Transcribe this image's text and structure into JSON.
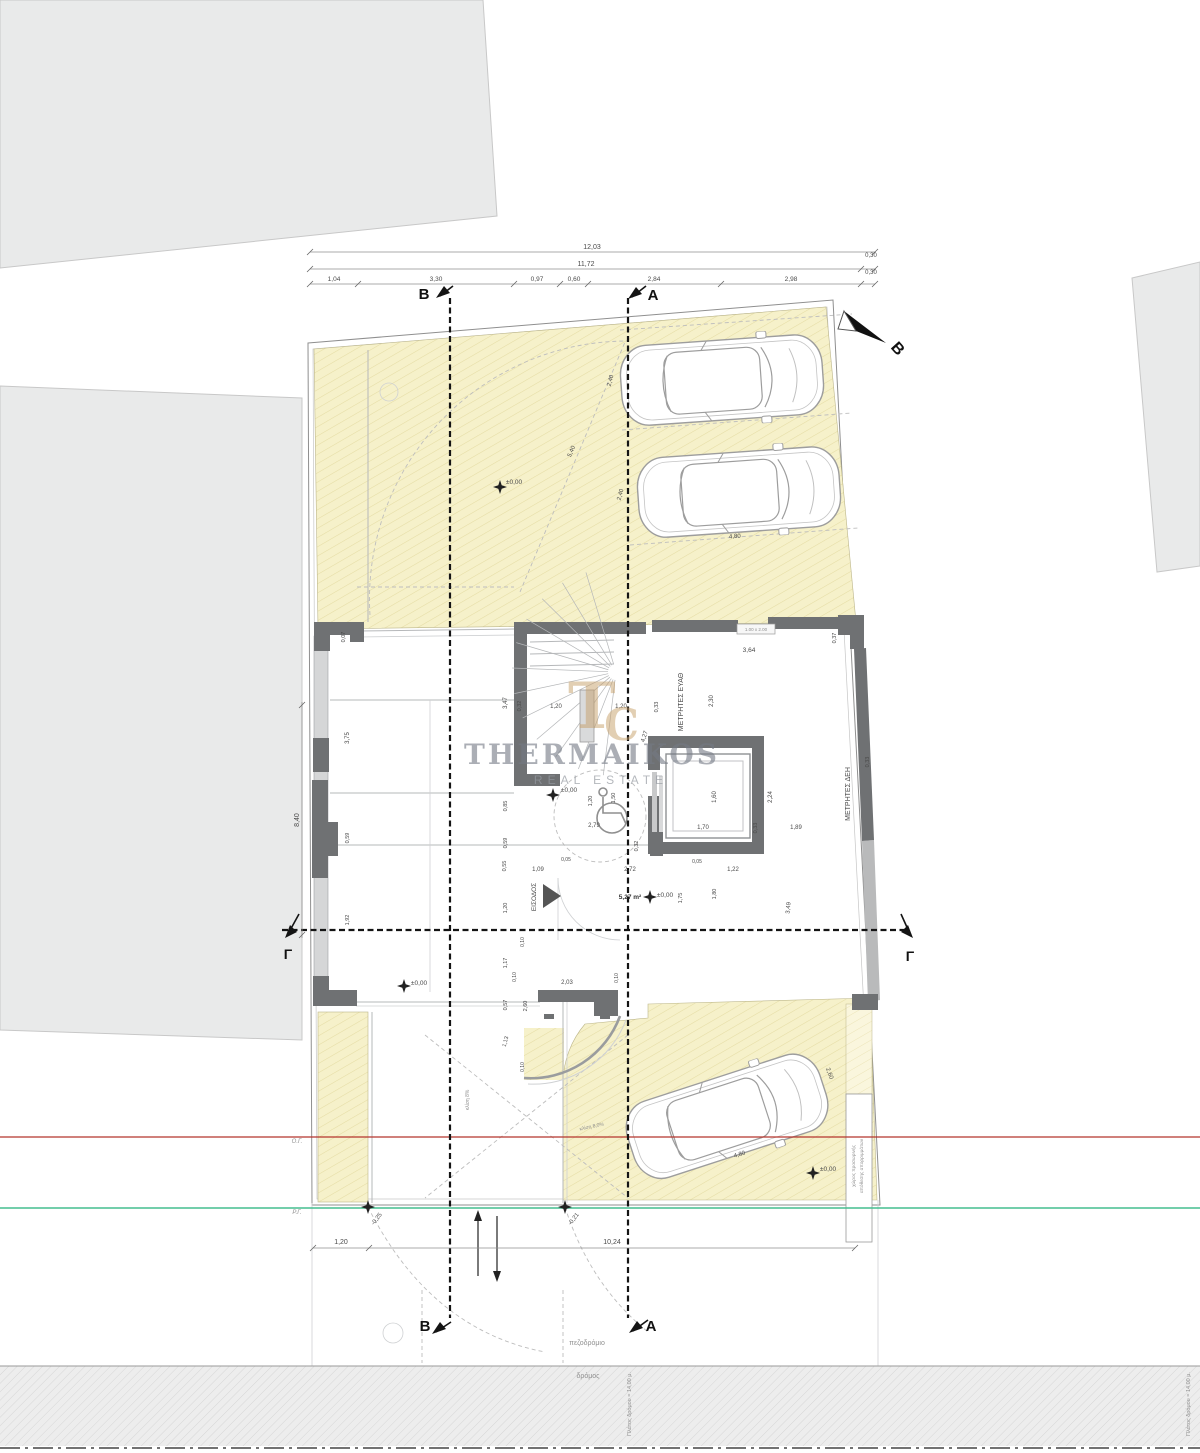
{
  "title": "Κάτοψη ισογείου",
  "branding": {
    "name": "THERMAIKOS",
    "subtitle": "REAL ESTATE",
    "monogram_left": "T",
    "monogram_right": "C",
    "logo_color": "#c7a06a",
    "text_color": "#747a85"
  },
  "colors": {
    "plot_fill": "#f6f1ca",
    "plot_hatch": "#e5dca4",
    "wall_dark": "#6f7173",
    "neighbor_fill": "#e9eaea",
    "building_line_red": "#b5352c",
    "street_line_green": "#45bd8f",
    "road_fill": "#ededed"
  },
  "legend": {
    "building_line": "Ο.Γ.",
    "street_line": "Ρ.Γ."
  },
  "labels": [
    {
      "n": "dim-total-top",
      "t": "12,03",
      "x": 592,
      "y": 249,
      "r": 0,
      "s": 7,
      "c": ""
    },
    {
      "n": "dim-top",
      "t": "11,72",
      "x": 586,
      "y": 266,
      "r": 0,
      "s": 7,
      "c": ""
    },
    {
      "n": "dim-top",
      "t": "0,30",
      "x": 871,
      "y": 257,
      "r": 0,
      "s": 6,
      "c": ""
    },
    {
      "n": "dim-top",
      "t": "0,30",
      "x": 871,
      "y": 274,
      "r": 0,
      "s": 6,
      "c": ""
    },
    {
      "n": "dim-top",
      "t": "1,04",
      "x": 334,
      "y": 281,
      "r": 0,
      "s": 6.5,
      "c": ""
    },
    {
      "n": "dim-top",
      "t": "3,30",
      "x": 436,
      "y": 281,
      "r": 0,
      "s": 6.5,
      "c": ""
    },
    {
      "n": "dim-top",
      "t": "0,97",
      "x": 537,
      "y": 281,
      "r": 0,
      "s": 6.5,
      "c": ""
    },
    {
      "n": "dim-top",
      "t": "0,60",
      "x": 574,
      "y": 281,
      "r": 0,
      "s": 6.5,
      "c": ""
    },
    {
      "n": "dim-top",
      "t": "2,84",
      "x": 654,
      "y": 281,
      "r": 0,
      "s": 6.5,
      "c": ""
    },
    {
      "n": "dim-top",
      "t": "2,98",
      "x": 791,
      "y": 281,
      "r": 0,
      "s": 6.5,
      "c": ""
    },
    {
      "n": "section-label-b-top",
      "t": "B",
      "x": 424,
      "y": 299,
      "r": 0,
      "s": 15,
      "c": "lbl-bold"
    },
    {
      "n": "section-label-a-top",
      "t": "A",
      "x": 653,
      "y": 300,
      "r": 0,
      "s": 15,
      "c": "lbl-bold"
    },
    {
      "n": "north-label",
      "t": "Β",
      "x": 894,
      "y": 352,
      "r": 48,
      "s": 16,
      "c": "lbl-bold"
    },
    {
      "n": "section-label-b-bottom",
      "t": "B",
      "x": 425,
      "y": 1331,
      "r": 0,
      "s": 15,
      "c": "lbl-bold"
    },
    {
      "n": "section-label-a-bottom",
      "t": "A",
      "x": 651,
      "y": 1331,
      "r": 0,
      "s": 15,
      "c": "lbl-bold"
    },
    {
      "n": "section-label-g-left",
      "t": "Γ",
      "x": 288,
      "y": 959,
      "r": 0,
      "s": 14,
      "c": "lbl-bold"
    },
    {
      "n": "section-label-g-right",
      "t": "Γ",
      "x": 910,
      "y": 961,
      "r": 0,
      "s": 14,
      "c": "lbl-bold"
    },
    {
      "n": "level-garden",
      "t": "±0,00",
      "x": 514,
      "y": 484,
      "r": 0,
      "s": 6.5,
      "c": ""
    },
    {
      "n": "dim-parking",
      "t": "2,40",
      "x": 612,
      "y": 381,
      "r": -75,
      "s": 6,
      "c": ""
    },
    {
      "n": "dim-parking",
      "t": "2,40",
      "x": 622,
      "y": 495,
      "r": -75,
      "s": 6,
      "c": ""
    },
    {
      "n": "dim-parking",
      "t": "5,40",
      "x": 573,
      "y": 452,
      "r": -67,
      "s": 6,
      "c": ""
    },
    {
      "n": "dim-parking",
      "t": "4,80",
      "x": 735,
      "y": 538,
      "r": -4,
      "s": 6,
      "c": ""
    },
    {
      "n": "dim",
      "t": "0,07",
      "x": 345,
      "y": 637,
      "r": -90,
      "s": 5.5,
      "c": ""
    },
    {
      "n": "dim",
      "t": "3,64",
      "x": 749,
      "y": 652,
      "r": 0,
      "s": 6.5,
      "c": ""
    },
    {
      "n": "window-size-label",
      "t": "1.00 x 2.00",
      "x": 756,
      "y": 631,
      "r": 0,
      "s": 4.5,
      "c": "lbl-faint"
    },
    {
      "n": "dim",
      "t": "0,37",
      "x": 836,
      "y": 638,
      "r": -90,
      "s": 5.5,
      "c": ""
    },
    {
      "n": "room-label-meters-eyath",
      "t": "ΜΕΤΡΗΤΕΣ ΕΥΑΘ",
      "x": 683,
      "y": 702,
      "r": -90,
      "s": 7,
      "c": ""
    },
    {
      "n": "dim",
      "t": "2,30",
      "x": 713,
      "y": 701,
      "r": -90,
      "s": 6,
      "c": ""
    },
    {
      "n": "dim",
      "t": "3,47",
      "x": 507,
      "y": 703,
      "r": -90,
      "s": 6,
      "c": ""
    },
    {
      "n": "dim",
      "t": "0,32",
      "x": 521,
      "y": 706,
      "r": -90,
      "s": 5.5,
      "c": ""
    },
    {
      "n": "dim",
      "t": "1,20",
      "x": 556,
      "y": 708,
      "r": 0,
      "s": 6,
      "c": ""
    },
    {
      "n": "dim",
      "t": "1,20",
      "x": 621,
      "y": 708,
      "r": 0,
      "s": 6,
      "c": ""
    },
    {
      "n": "dim",
      "t": "0,33",
      "x": 658,
      "y": 707,
      "r": -90,
      "s": 5.5,
      "c": ""
    },
    {
      "n": "dim",
      "t": "4,27",
      "x": 646,
      "y": 737,
      "r": -72,
      "s": 6,
      "c": ""
    },
    {
      "n": "dim",
      "t": "0,33",
      "x": 869,
      "y": 762,
      "r": -90,
      "s": 5.5,
      "c": ""
    },
    {
      "n": "dim",
      "t": "3,75",
      "x": 349,
      "y": 738,
      "r": -90,
      "s": 6,
      "c": ""
    },
    {
      "n": "dim-left-total",
      "t": "8,40",
      "x": 299,
      "y": 820,
      "r": -90,
      "s": 7,
      "c": ""
    },
    {
      "n": "dim",
      "t": "0,59",
      "x": 349,
      "y": 838,
      "r": -90,
      "s": 5.5,
      "c": ""
    },
    {
      "n": "dim",
      "t": "1,92",
      "x": 349,
      "y": 920,
      "r": -90,
      "s": 5.5,
      "c": ""
    },
    {
      "n": "dim-elevator",
      "t": "1,60",
      "x": 716,
      "y": 797,
      "r": -90,
      "s": 6,
      "c": ""
    },
    {
      "n": "dim-elevator",
      "t": "1,70",
      "x": 703,
      "y": 829,
      "r": 0,
      "s": 6,
      "c": ""
    },
    {
      "n": "dim-elevator",
      "t": "0,33",
      "x": 757,
      "y": 828,
      "r": -90,
      "s": 5.5,
      "c": ""
    },
    {
      "n": "dim",
      "t": "2,24",
      "x": 772,
      "y": 797,
      "r": -90,
      "s": 6,
      "c": ""
    },
    {
      "n": "dim",
      "t": "1,89",
      "x": 796,
      "y": 829,
      "r": 0,
      "s": 6,
      "c": ""
    },
    {
      "n": "room-label-meters-deh",
      "t": "ΜΕΤΡΗΤΕΣ ΔΕΗ",
      "x": 850,
      "y": 794,
      "r": -90,
      "s": 7,
      "c": ""
    },
    {
      "n": "level-hall",
      "t": "±0,00",
      "x": 569,
      "y": 792,
      "r": 0,
      "s": 6.5,
      "c": ""
    },
    {
      "n": "dim",
      "t": "1,20",
      "x": 592,
      "y": 801,
      "r": -90,
      "s": 5.5,
      "c": ""
    },
    {
      "n": "dim",
      "t": "1,50",
      "x": 615,
      "y": 798,
      "r": -90,
      "s": 5.5,
      "c": ""
    },
    {
      "n": "dim",
      "t": "2,79",
      "x": 594,
      "y": 827,
      "r": 0,
      "s": 6,
      "c": ""
    },
    {
      "n": "dim",
      "t": "0,32",
      "x": 638,
      "y": 846,
      "r": -90,
      "s": 5.5,
      "c": ""
    },
    {
      "n": "dim",
      "t": "0,85",
      "x": 507,
      "y": 806,
      "r": -90,
      "s": 5.5,
      "c": ""
    },
    {
      "n": "dim",
      "t": "0,59",
      "x": 507,
      "y": 843,
      "r": -90,
      "s": 5.5,
      "c": ""
    },
    {
      "n": "dim",
      "t": "0,55",
      "x": 506,
      "y": 866,
      "r": -90,
      "s": 5.5,
      "c": ""
    },
    {
      "n": "dim",
      "t": "1,09",
      "x": 538,
      "y": 871,
      "r": 0,
      "s": 6,
      "c": ""
    },
    {
      "n": "dim",
      "t": "0,05",
      "x": 566,
      "y": 861,
      "r": 0,
      "s": 5,
      "c": ""
    },
    {
      "n": "dim",
      "t": "2,72",
      "x": 630,
      "y": 871,
      "r": 0,
      "s": 6,
      "c": ""
    },
    {
      "n": "dim",
      "t": "0,05",
      "x": 697,
      "y": 863,
      "r": 0,
      "s": 5,
      "c": ""
    },
    {
      "n": "dim",
      "t": "1,22",
      "x": 733,
      "y": 871,
      "r": 0,
      "s": 6,
      "c": ""
    },
    {
      "n": "dim",
      "t": "1,20",
      "x": 507,
      "y": 908,
      "r": -90,
      "s": 5.5,
      "c": ""
    },
    {
      "n": "room-label-entrance",
      "t": "ΕΙΣΟΔΟΣ",
      "x": 536,
      "y": 897,
      "r": -90,
      "s": 6.5,
      "c": ""
    },
    {
      "n": "area-label",
      "t": "5,27 m²",
      "x": 630,
      "y": 899,
      "r": 0,
      "s": 6.5,
      "c": "lbl-semibold"
    },
    {
      "n": "level-walkway",
      "t": "±0,00",
      "x": 665,
      "y": 897,
      "r": 0,
      "s": 6.5,
      "c": ""
    },
    {
      "n": "dim",
      "t": "1,75",
      "x": 682,
      "y": 898,
      "r": -90,
      "s": 5.5,
      "c": ""
    },
    {
      "n": "dim",
      "t": "1,80",
      "x": 716,
      "y": 894,
      "r": -90,
      "s": 5.5,
      "c": ""
    },
    {
      "n": "dim",
      "t": "3,49",
      "x": 790,
      "y": 908,
      "r": -85,
      "s": 6,
      "c": ""
    },
    {
      "n": "level-pilotis",
      "t": "±0,00",
      "x": 419,
      "y": 985,
      "r": 0,
      "s": 6.5,
      "c": ""
    },
    {
      "n": "dim",
      "t": "1,17",
      "x": 507,
      "y": 963,
      "r": -90,
      "s": 5.5,
      "c": ""
    },
    {
      "n": "dim",
      "t": "0,10",
      "x": 524,
      "y": 942,
      "r": -90,
      "s": 5,
      "c": ""
    },
    {
      "n": "dim",
      "t": "0,10",
      "x": 516,
      "y": 977,
      "r": -90,
      "s": 5,
      "c": ""
    },
    {
      "n": "dim",
      "t": "2,03",
      "x": 567,
      "y": 984,
      "r": 0,
      "s": 6,
      "c": ""
    },
    {
      "n": "dim",
      "t": "0,10",
      "x": 618,
      "y": 978,
      "r": -90,
      "s": 5,
      "c": ""
    },
    {
      "n": "dim",
      "t": "0,57",
      "x": 507,
      "y": 1005,
      "r": -90,
      "s": 5.5,
      "c": ""
    },
    {
      "n": "dim",
      "t": "2,60",
      "x": 527,
      "y": 1006,
      "r": -90,
      "s": 5.5,
      "c": ""
    },
    {
      "n": "dim",
      "t": "1,13",
      "x": 507,
      "y": 1042,
      "r": -75,
      "s": 5.5,
      "c": ""
    },
    {
      "n": "dim",
      "t": "0,10",
      "x": 524,
      "y": 1067,
      "r": -90,
      "s": 5,
      "c": ""
    },
    {
      "n": "slope-note",
      "t": "κλίση 8%",
      "x": 469,
      "y": 1100,
      "r": -90,
      "s": 5,
      "c": "lbl-faint"
    },
    {
      "n": "slope-note",
      "t": "κλίση 8,0%",
      "x": 592,
      "y": 1128,
      "r": -12,
      "s": 5,
      "c": "lbl-faint"
    },
    {
      "n": "dim-parking",
      "t": "4,80",
      "x": 740,
      "y": 1156,
      "r": -17,
      "s": 6,
      "c": ""
    },
    {
      "n": "dim-parking",
      "t": "2,60",
      "x": 828,
      "y": 1074,
      "r": 70,
      "s": 6,
      "c": ""
    },
    {
      "n": "level-parking",
      "t": "±0,00",
      "x": 828,
      "y": 1171,
      "r": 0,
      "s": 6.5,
      "c": ""
    },
    {
      "n": "waste-area-note",
      "t": "χώρος προσωρινής",
      "x": 855,
      "y": 1166,
      "r": -90,
      "s": 4.8,
      "c": "lbl-faint"
    },
    {
      "n": "waste-area-note",
      "t": "απόθεσης απορριμμάτων",
      "x": 863,
      "y": 1166,
      "r": -90,
      "s": 4.8,
      "c": "lbl-faint"
    },
    {
      "n": "level-sidewalk",
      "t": "-0,25",
      "x": 378,
      "y": 1220,
      "r": -52,
      "s": 6,
      "c": ""
    },
    {
      "n": "level-sidewalk",
      "t": "-0,21",
      "x": 575,
      "y": 1220,
      "r": -52,
      "s": 6,
      "c": ""
    },
    {
      "n": "dim-bottom",
      "t": "1,20",
      "x": 341,
      "y": 1244,
      "r": 0,
      "s": 7,
      "c": ""
    },
    {
      "n": "dim-bottom",
      "t": "10,24",
      "x": 612,
      "y": 1244,
      "r": 0,
      "s": 7,
      "c": ""
    },
    {
      "n": "sidewalk-label",
      "t": "πεζοδρόμιο",
      "x": 587,
      "y": 1345,
      "r": 0,
      "s": 7,
      "c": "lbl-faint"
    },
    {
      "n": "road-label",
      "t": "δρόμος",
      "x": 588,
      "y": 1378,
      "r": 0,
      "s": 7,
      "c": "lbl-faint"
    },
    {
      "n": "road-width-note",
      "t": "Πλάτος δρόμου = 14,00 μ.",
      "x": 631,
      "y": 1404,
      "r": -90,
      "s": 5.5,
      "c": "lbl-faint"
    },
    {
      "n": "road-width-note",
      "t": "Πλάτος δρόμου = 14,00 μ.",
      "x": 1190,
      "y": 1404,
      "r": -90,
      "s": 5.5,
      "c": "lbl-faint"
    },
    {
      "n": "building-line-label",
      "t": "Ο.Γ.",
      "x": 297,
      "y": 1143,
      "r": 0,
      "s": 6,
      "c": "lbl-italic"
    },
    {
      "n": "street-line-label",
      "t": "Ρ.Γ.",
      "x": 297,
      "y": 1214,
      "r": 0,
      "s": 6,
      "c": "lbl-italic"
    }
  ],
  "level_markers": [
    {
      "x": 500,
      "y": 487
    },
    {
      "x": 553,
      "y": 795
    },
    {
      "x": 404,
      "y": 986
    },
    {
      "x": 650,
      "y": 897
    },
    {
      "x": 813,
      "y": 1173
    },
    {
      "x": 368,
      "y": 1207
    },
    {
      "x": 565,
      "y": 1207
    }
  ]
}
